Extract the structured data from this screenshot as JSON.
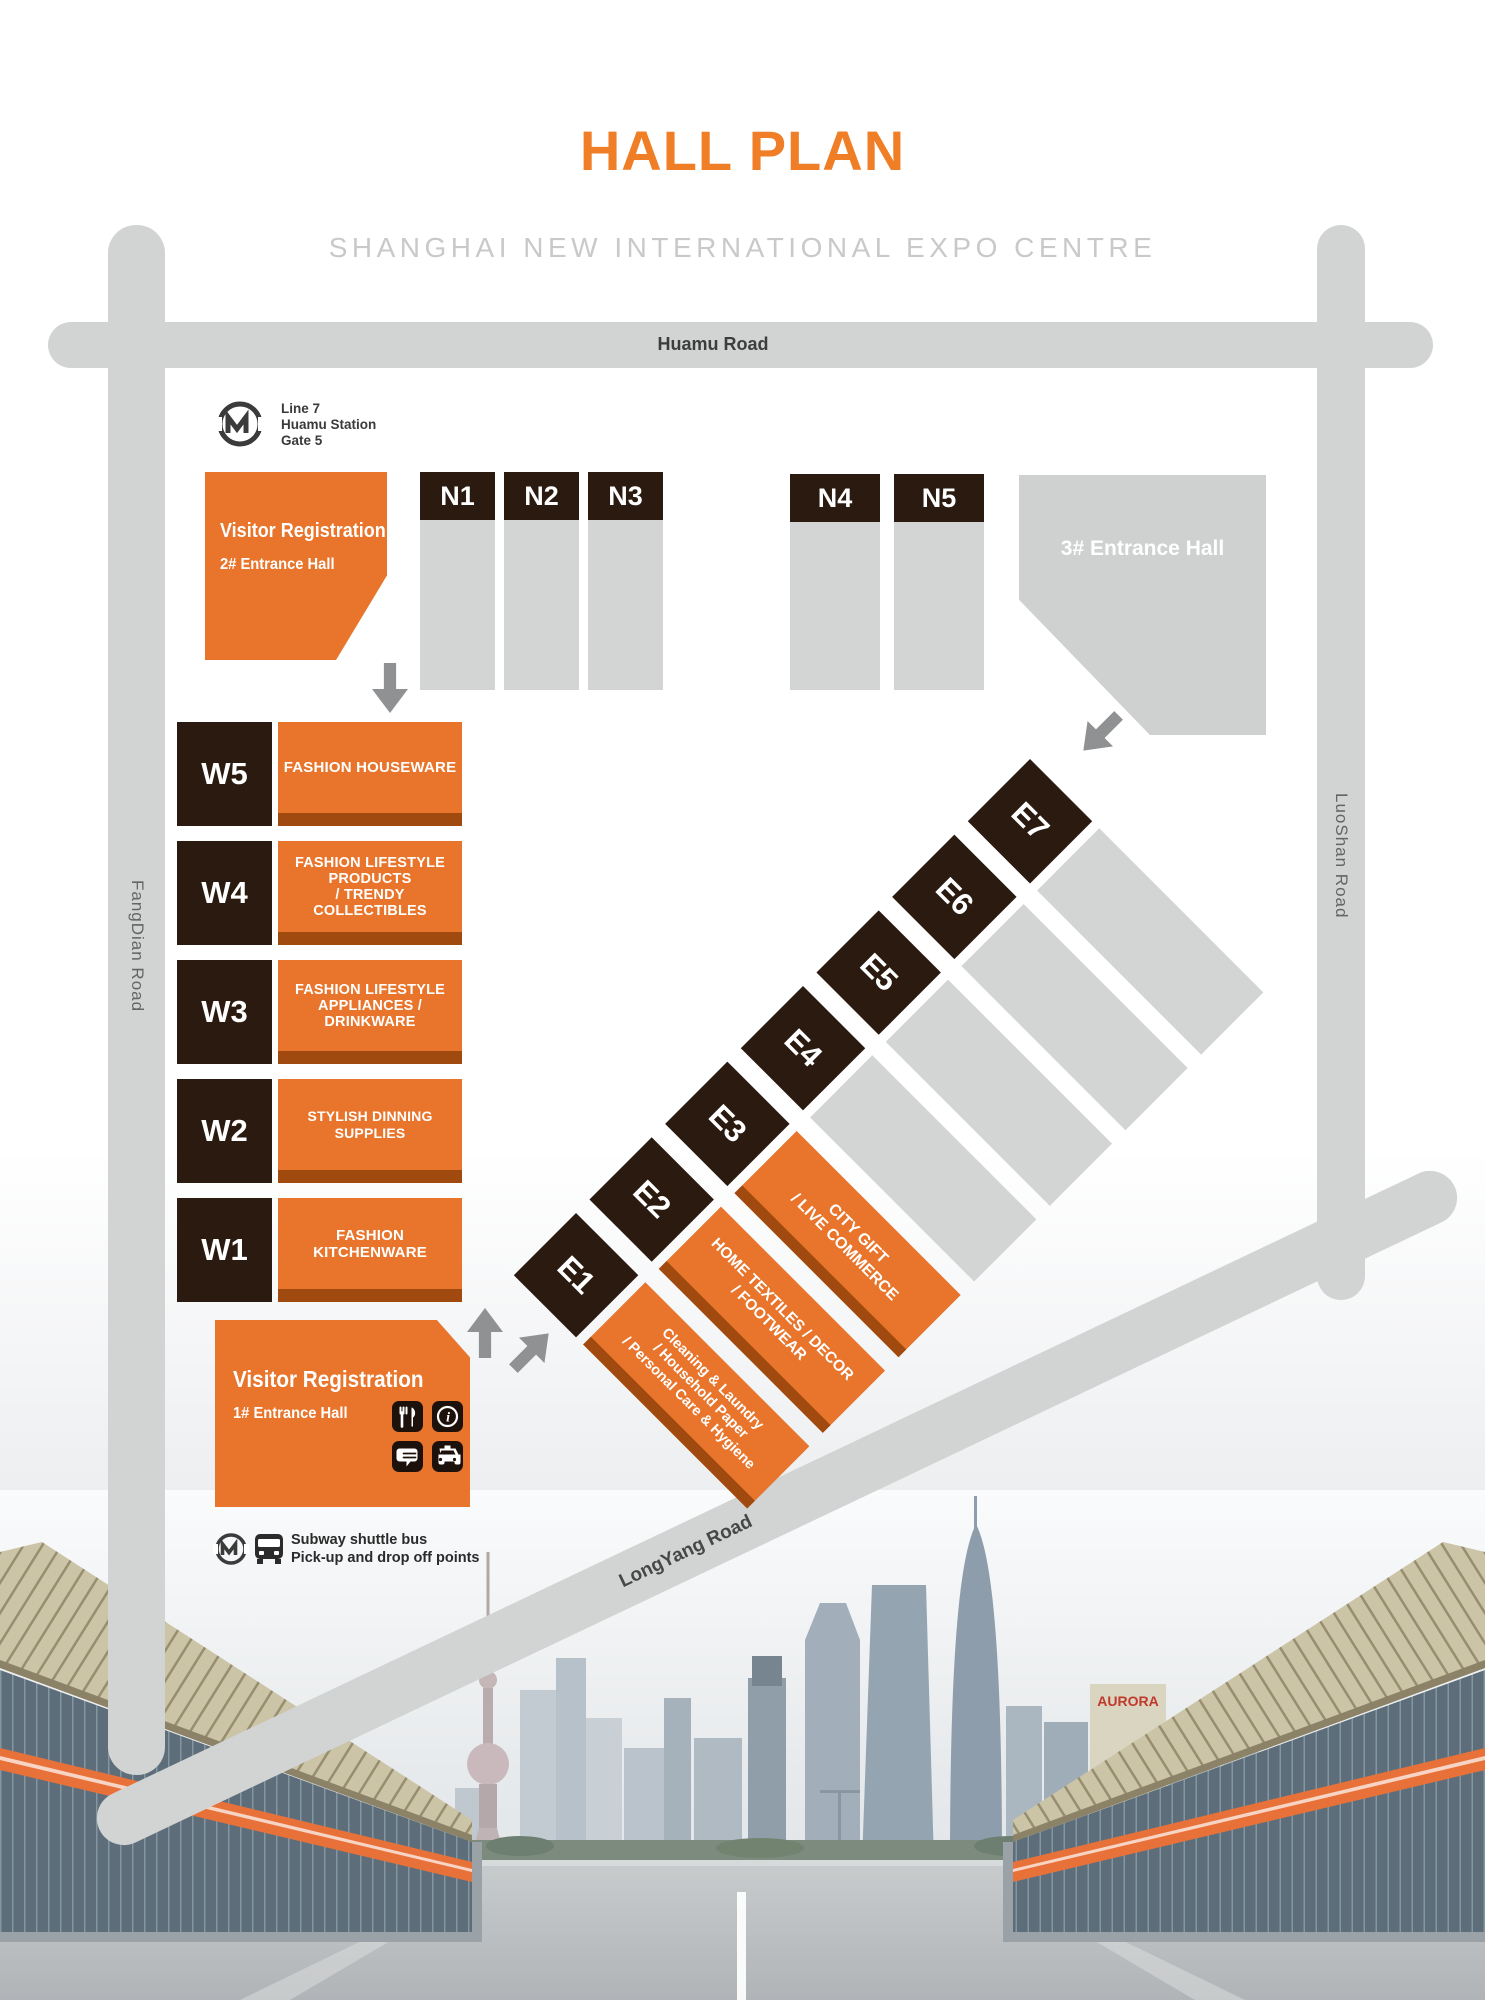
{
  "title": "HALL PLAN",
  "subtitle": "SHANGHAI NEW INTERNATIONAL EXPO CENTRE",
  "roads": {
    "top": "Huamu Road",
    "left": "FangDian Road",
    "right": "LuoShan Road",
    "bottom": "LongYang Road"
  },
  "metro_station": {
    "line": "Line 7",
    "station": "Huamu Station",
    "gate": "Gate 5"
  },
  "registration_north": {
    "title": "Visitor Registration",
    "hall": "2# Entrance Hall"
  },
  "registration_south": {
    "title": "Visitor Registration",
    "hall": "1# Entrance Hall"
  },
  "entrance3_label": "3# Entrance Hall",
  "north_halls": [
    "N1",
    "N2",
    "N3",
    "N4",
    "N5"
  ],
  "west_halls": [
    {
      "id": "W5",
      "label": "FASHION HOUSEWARE"
    },
    {
      "id": "W4",
      "label": "FASHION LIFESTYLE\nPRODUCTS\n/ TRENDY COLLECTIBLES"
    },
    {
      "id": "W3",
      "label": "FASHION LIFESTYLE\nAPPLIANCES / DRINKWARE"
    },
    {
      "id": "W2",
      "label": "STYLISH DINNING SUPPLIES"
    },
    {
      "id": "W1",
      "label": "FASHION KITCHENWARE"
    }
  ],
  "east_halls": [
    {
      "id": "E1",
      "label": "Cleaning & Laundry\n/ Household Paper\n/ Personal Care & Hygiene"
    },
    {
      "id": "E2",
      "label": "HOME TEXTILES / DECOR\n/ FOOTWEAR"
    },
    {
      "id": "E3",
      "label": "CITY GIFT\n/ LIVE COMMERCE"
    },
    {
      "id": "E4",
      "label": ""
    },
    {
      "id": "E5",
      "label": ""
    },
    {
      "id": "E6",
      "label": ""
    },
    {
      "id": "E7",
      "label": ""
    }
  ],
  "legend": {
    "line1": "Subway shuttle bus",
    "line2": "Pick-up and drop off points"
  },
  "icons": {
    "metro_logo": "metro-logo-icon",
    "bus": "bus-icon",
    "restaurant": "restaurant-icon",
    "info": "info-icon",
    "chat": "chat-icon",
    "taxi": "taxi-icon",
    "arrows": [
      "down-arrow-icon",
      "down-left-arrow-icon",
      "up-arrow-icon",
      "up-right-arrow-icon"
    ]
  },
  "colors": {
    "accent_orange": "#E8752B",
    "dark_orange": "#A04A10",
    "hall_black": "#2A1A10",
    "road_gray": "#D2D3D3",
    "title_orange": "#F07E26",
    "subtitle_gray": "#C9C9C9",
    "arrow_gray": "#8F9192"
  },
  "photo": {
    "aurora_sign": "AURORA"
  }
}
